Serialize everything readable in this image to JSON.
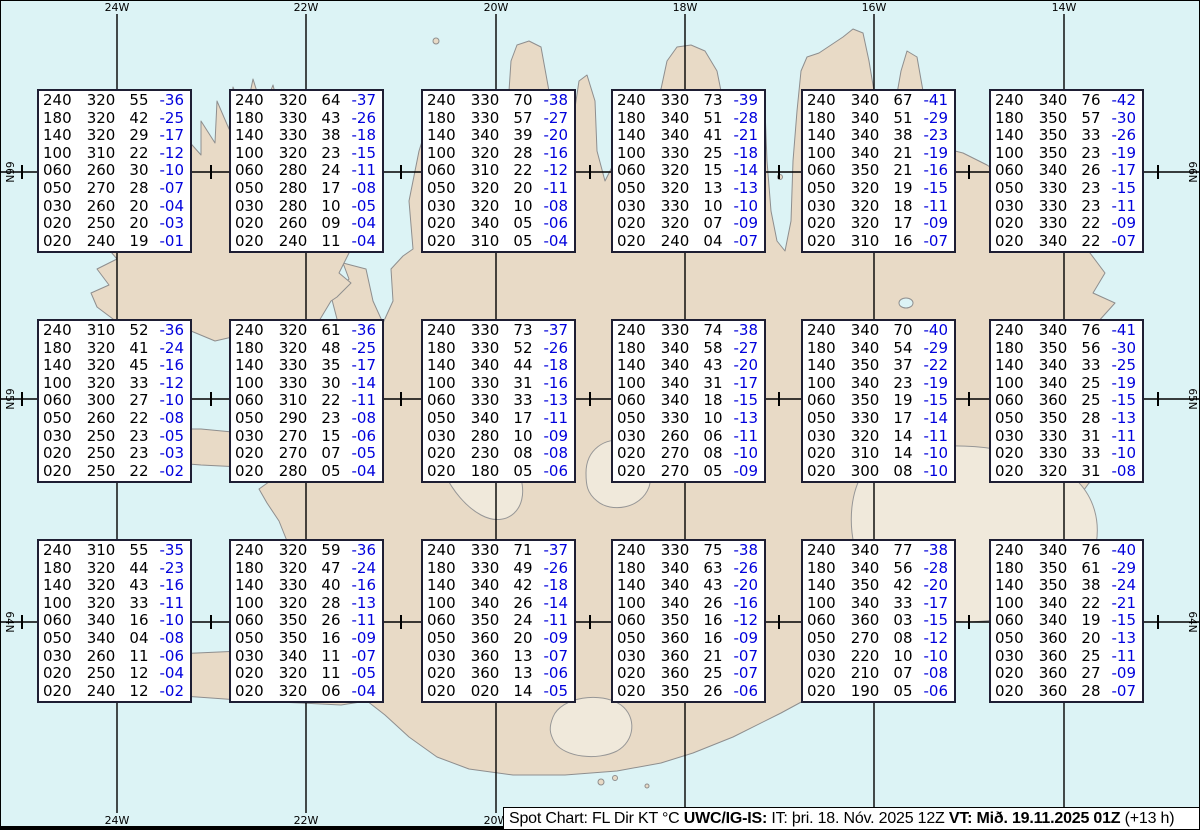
{
  "colors": {
    "water": "#dcf3f5",
    "land": "#e8dac6",
    "coast": "#8e8e8e",
    "glacier": "#f0e9db",
    "grid": "#000000",
    "temp": "#0000dd",
    "box_border": "#1e1e33"
  },
  "graticule": {
    "lon_lines": [
      {
        "label": "24W",
        "x": 116
      },
      {
        "label": "22W",
        "x": 305
      },
      {
        "label": "20W",
        "x": 495
      },
      {
        "label": "18W",
        "x": 684
      },
      {
        "label": "16W",
        "x": 873
      },
      {
        "label": "14W",
        "x": 1063
      }
    ],
    "lat_lines": [
      {
        "label": "66N",
        "y": 171
      },
      {
        "label": "65N",
        "y": 398
      },
      {
        "label": "64N",
        "y": 621
      }
    ],
    "minor_ticks_x": [
      21,
      210,
      400,
      589,
      778,
      968,
      1157
    ]
  },
  "spots": [
    {
      "x": 36,
      "y": 88,
      "rows": [
        [
          "240",
          "320",
          "55",
          "-36"
        ],
        [
          "180",
          "320",
          "42",
          "-25"
        ],
        [
          "140",
          "320",
          "29",
          "-17"
        ],
        [
          "100",
          "310",
          "22",
          "-12"
        ],
        [
          "060",
          "260",
          "30",
          "-10"
        ],
        [
          "050",
          "270",
          "28",
          "-07"
        ],
        [
          "030",
          "260",
          "20",
          "-04"
        ],
        [
          "020",
          "250",
          "20",
          "-03"
        ],
        [
          "020",
          "240",
          "19",
          "-01"
        ]
      ]
    },
    {
      "x": 228,
      "y": 88,
      "rows": [
        [
          "240",
          "320",
          "64",
          "-37"
        ],
        [
          "180",
          "330",
          "43",
          "-26"
        ],
        [
          "140",
          "330",
          "38",
          "-18"
        ],
        [
          "100",
          "320",
          "23",
          "-15"
        ],
        [
          "060",
          "280",
          "24",
          "-11"
        ],
        [
          "050",
          "280",
          "17",
          "-08"
        ],
        [
          "030",
          "280",
          "10",
          "-05"
        ],
        [
          "020",
          "260",
          "09",
          "-04"
        ],
        [
          "020",
          "240",
          "11",
          "-04"
        ]
      ]
    },
    {
      "x": 420,
      "y": 88,
      "rows": [
        [
          "240",
          "330",
          "70",
          "-38"
        ],
        [
          "180",
          "330",
          "57",
          "-27"
        ],
        [
          "140",
          "340",
          "39",
          "-20"
        ],
        [
          "100",
          "320",
          "28",
          "-16"
        ],
        [
          "060",
          "310",
          "22",
          "-12"
        ],
        [
          "050",
          "320",
          "20",
          "-11"
        ],
        [
          "030",
          "320",
          "10",
          "-08"
        ],
        [
          "020",
          "340",
          "05",
          "-06"
        ],
        [
          "020",
          "310",
          "05",
          "-04"
        ]
      ]
    },
    {
      "x": 610,
      "y": 88,
      "rows": [
        [
          "240",
          "330",
          "73",
          "-39"
        ],
        [
          "180",
          "340",
          "51",
          "-28"
        ],
        [
          "140",
          "340",
          "41",
          "-21"
        ],
        [
          "100",
          "330",
          "25",
          "-18"
        ],
        [
          "060",
          "320",
          "15",
          "-14"
        ],
        [
          "050",
          "320",
          "13",
          "-13"
        ],
        [
          "030",
          "330",
          "10",
          "-10"
        ],
        [
          "020",
          "320",
          "07",
          "-09"
        ],
        [
          "020",
          "240",
          "04",
          "-07"
        ]
      ]
    },
    {
      "x": 800,
      "y": 88,
      "rows": [
        [
          "240",
          "340",
          "67",
          "-41"
        ],
        [
          "180",
          "340",
          "51",
          "-29"
        ],
        [
          "140",
          "340",
          "38",
          "-23"
        ],
        [
          "100",
          "340",
          "21",
          "-19"
        ],
        [
          "060",
          "350",
          "21",
          "-16"
        ],
        [
          "050",
          "320",
          "19",
          "-15"
        ],
        [
          "030",
          "320",
          "18",
          "-11"
        ],
        [
          "020",
          "320",
          "17",
          "-09"
        ],
        [
          "020",
          "310",
          "16",
          "-07"
        ]
      ]
    },
    {
      "x": 988,
      "y": 88,
      "rows": [
        [
          "240",
          "340",
          "76",
          "-42"
        ],
        [
          "180",
          "350",
          "57",
          "-30"
        ],
        [
          "140",
          "350",
          "33",
          "-26"
        ],
        [
          "100",
          "350",
          "23",
          "-19"
        ],
        [
          "060",
          "340",
          "26",
          "-17"
        ],
        [
          "050",
          "330",
          "23",
          "-15"
        ],
        [
          "030",
          "330",
          "23",
          "-11"
        ],
        [
          "020",
          "330",
          "22",
          "-09"
        ],
        [
          "020",
          "340",
          "22",
          "-07"
        ]
      ]
    },
    {
      "x": 36,
      "y": 318,
      "rows": [
        [
          "240",
          "310",
          "52",
          "-36"
        ],
        [
          "180",
          "320",
          "41",
          "-24"
        ],
        [
          "140",
          "320",
          "45",
          "-16"
        ],
        [
          "100",
          "320",
          "33",
          "-12"
        ],
        [
          "060",
          "300",
          "27",
          "-10"
        ],
        [
          "050",
          "260",
          "22",
          "-08"
        ],
        [
          "030",
          "250",
          "23",
          "-05"
        ],
        [
          "020",
          "250",
          "23",
          "-03"
        ],
        [
          "020",
          "250",
          "22",
          "-02"
        ]
      ]
    },
    {
      "x": 228,
      "y": 318,
      "rows": [
        [
          "240",
          "320",
          "61",
          "-36"
        ],
        [
          "180",
          "320",
          "48",
          "-25"
        ],
        [
          "140",
          "330",
          "35",
          "-17"
        ],
        [
          "100",
          "330",
          "30",
          "-14"
        ],
        [
          "060",
          "310",
          "22",
          "-11"
        ],
        [
          "050",
          "290",
          "23",
          "-08"
        ],
        [
          "030",
          "270",
          "15",
          "-06"
        ],
        [
          "020",
          "270",
          "07",
          "-05"
        ],
        [
          "020",
          "280",
          "05",
          "-04"
        ]
      ]
    },
    {
      "x": 420,
      "y": 318,
      "rows": [
        [
          "240",
          "330",
          "73",
          "-37"
        ],
        [
          "180",
          "330",
          "52",
          "-26"
        ],
        [
          "140",
          "340",
          "44",
          "-18"
        ],
        [
          "100",
          "330",
          "31",
          "-16"
        ],
        [
          "060",
          "330",
          "33",
          "-13"
        ],
        [
          "050",
          "340",
          "17",
          "-11"
        ],
        [
          "030",
          "280",
          "10",
          "-09"
        ],
        [
          "020",
          "230",
          "08",
          "-08"
        ],
        [
          "020",
          "180",
          "05",
          "-06"
        ]
      ]
    },
    {
      "x": 610,
      "y": 318,
      "rows": [
        [
          "240",
          "330",
          "74",
          "-38"
        ],
        [
          "180",
          "340",
          "58",
          "-27"
        ],
        [
          "140",
          "340",
          "43",
          "-20"
        ],
        [
          "100",
          "340",
          "31",
          "-17"
        ],
        [
          "060",
          "340",
          "18",
          "-15"
        ],
        [
          "050",
          "330",
          "10",
          "-13"
        ],
        [
          "030",
          "260",
          "06",
          "-11"
        ],
        [
          "020",
          "270",
          "08",
          "-10"
        ],
        [
          "020",
          "270",
          "05",
          "-09"
        ]
      ]
    },
    {
      "x": 800,
      "y": 318,
      "rows": [
        [
          "240",
          "340",
          "70",
          "-40"
        ],
        [
          "180",
          "340",
          "54",
          "-29"
        ],
        [
          "140",
          "350",
          "37",
          "-22"
        ],
        [
          "100",
          "340",
          "23",
          "-19"
        ],
        [
          "060",
          "350",
          "19",
          "-15"
        ],
        [
          "050",
          "330",
          "17",
          "-14"
        ],
        [
          "030",
          "320",
          "14",
          "-11"
        ],
        [
          "020",
          "310",
          "14",
          "-10"
        ],
        [
          "020",
          "300",
          "08",
          "-10"
        ]
      ]
    },
    {
      "x": 988,
      "y": 318,
      "rows": [
        [
          "240",
          "340",
          "76",
          "-41"
        ],
        [
          "180",
          "350",
          "56",
          "-30"
        ],
        [
          "140",
          "340",
          "33",
          "-25"
        ],
        [
          "100",
          "340",
          "25",
          "-19"
        ],
        [
          "060",
          "360",
          "25",
          "-15"
        ],
        [
          "050",
          "350",
          "28",
          "-13"
        ],
        [
          "030",
          "330",
          "31",
          "-11"
        ],
        [
          "020",
          "330",
          "33",
          "-10"
        ],
        [
          "020",
          "320",
          "31",
          "-08"
        ]
      ]
    },
    {
      "x": 36,
      "y": 538,
      "rows": [
        [
          "240",
          "310",
          "55",
          "-35"
        ],
        [
          "180",
          "320",
          "44",
          "-23"
        ],
        [
          "140",
          "320",
          "43",
          "-16"
        ],
        [
          "100",
          "320",
          "33",
          "-11"
        ],
        [
          "060",
          "340",
          "16",
          "-10"
        ],
        [
          "050",
          "340",
          "04",
          "-08"
        ],
        [
          "030",
          "260",
          "11",
          "-06"
        ],
        [
          "020",
          "250",
          "12",
          "-04"
        ],
        [
          "020",
          "240",
          "12",
          "-02"
        ]
      ]
    },
    {
      "x": 228,
      "y": 538,
      "rows": [
        [
          "240",
          "320",
          "59",
          "-36"
        ],
        [
          "180",
          "320",
          "47",
          "-24"
        ],
        [
          "140",
          "330",
          "40",
          "-16"
        ],
        [
          "100",
          "320",
          "28",
          "-13"
        ],
        [
          "060",
          "350",
          "26",
          "-11"
        ],
        [
          "050",
          "350",
          "16",
          "-09"
        ],
        [
          "030",
          "340",
          "11",
          "-07"
        ],
        [
          "020",
          "320",
          "11",
          "-05"
        ],
        [
          "020",
          "320",
          "06",
          "-04"
        ]
      ]
    },
    {
      "x": 420,
      "y": 538,
      "rows": [
        [
          "240",
          "330",
          "71",
          "-37"
        ],
        [
          "180",
          "330",
          "49",
          "-26"
        ],
        [
          "140",
          "340",
          "42",
          "-18"
        ],
        [
          "100",
          "340",
          "26",
          "-14"
        ],
        [
          "060",
          "350",
          "24",
          "-11"
        ],
        [
          "050",
          "360",
          "20",
          "-09"
        ],
        [
          "030",
          "360",
          "13",
          "-07"
        ],
        [
          "020",
          "360",
          "13",
          "-06"
        ],
        [
          "020",
          "020",
          "14",
          "-05"
        ]
      ]
    },
    {
      "x": 610,
      "y": 538,
      "rows": [
        [
          "240",
          "330",
          "75",
          "-38"
        ],
        [
          "180",
          "340",
          "63",
          "-26"
        ],
        [
          "140",
          "340",
          "43",
          "-20"
        ],
        [
          "100",
          "340",
          "26",
          "-16"
        ],
        [
          "060",
          "350",
          "16",
          "-12"
        ],
        [
          "050",
          "360",
          "16",
          "-09"
        ],
        [
          "030",
          "360",
          "21",
          "-07"
        ],
        [
          "020",
          "360",
          "25",
          "-07"
        ],
        [
          "020",
          "350",
          "26",
          "-06"
        ]
      ]
    },
    {
      "x": 800,
      "y": 538,
      "rows": [
        [
          "240",
          "340",
          "77",
          "-38"
        ],
        [
          "180",
          "340",
          "56",
          "-28"
        ],
        [
          "140",
          "350",
          "42",
          "-20"
        ],
        [
          "100",
          "340",
          "33",
          "-17"
        ],
        [
          "060",
          "360",
          "03",
          "-15"
        ],
        [
          "050",
          "270",
          "08",
          "-12"
        ],
        [
          "030",
          "220",
          "10",
          "-10"
        ],
        [
          "020",
          "210",
          "07",
          "-08"
        ],
        [
          "020",
          "190",
          "05",
          "-06"
        ]
      ]
    },
    {
      "x": 988,
      "y": 538,
      "rows": [
        [
          "240",
          "340",
          "76",
          "-40"
        ],
        [
          "180",
          "350",
          "61",
          "-29"
        ],
        [
          "140",
          "350",
          "38",
          "-24"
        ],
        [
          "100",
          "340",
          "22",
          "-21"
        ],
        [
          "060",
          "340",
          "19",
          "-15"
        ],
        [
          "050",
          "360",
          "20",
          "-13"
        ],
        [
          "030",
          "360",
          "25",
          "-11"
        ],
        [
          "020",
          "360",
          "27",
          "-09"
        ],
        [
          "020",
          "360",
          "28",
          "-07"
        ]
      ]
    }
  ],
  "footer": {
    "segments": [
      {
        "text": "Spot Chart: FL Dir KT °C ",
        "bold": false
      },
      {
        "text": "UWC/IG-IS:",
        "bold": true
      },
      {
        "text": " IT: þri. 18. Nóv. 2025 12Z ",
        "bold": false
      },
      {
        "text": "VT: Mið. 19.11.2025 01Z",
        "bold": true
      },
      {
        "text": " (+13 h)",
        "bold": false
      }
    ]
  }
}
